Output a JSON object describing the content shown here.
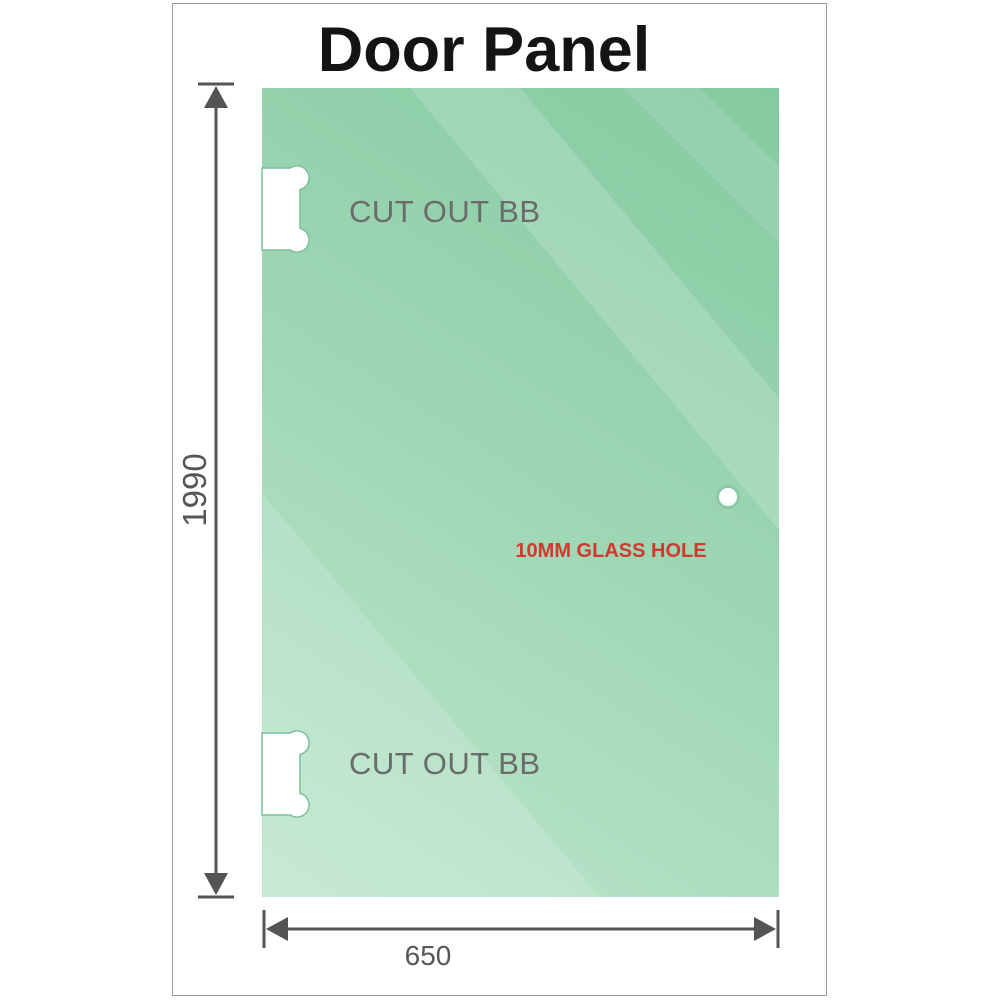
{
  "title": "Door Panel",
  "panel": {
    "cutout_top_label": "CUT OUT BB",
    "cutout_bottom_label": "CUT OUT BB",
    "glass_hole_label": "10MM GLASS HOLE"
  },
  "dimensions": {
    "height_mm": "1990",
    "width_mm": "650"
  },
  "colors": {
    "glass_dark": "#84caa0",
    "glass_mid": "#9fd7b5",
    "glass_light": "#bfe7ce",
    "streak_white": "#ffffff",
    "cutout_fill": "#ffffff",
    "cutout_outline": "#7cc09a",
    "hole_fill": "#ffffff",
    "hole_ring": "#8cc9a8",
    "dimension_line": "#545454",
    "dimension_text": "#565656",
    "cutout_label_gray": "#6b6b6b",
    "hole_label_red": "#d4372d",
    "frame_border": "#9c9c9c",
    "title_color": "#141414"
  }
}
